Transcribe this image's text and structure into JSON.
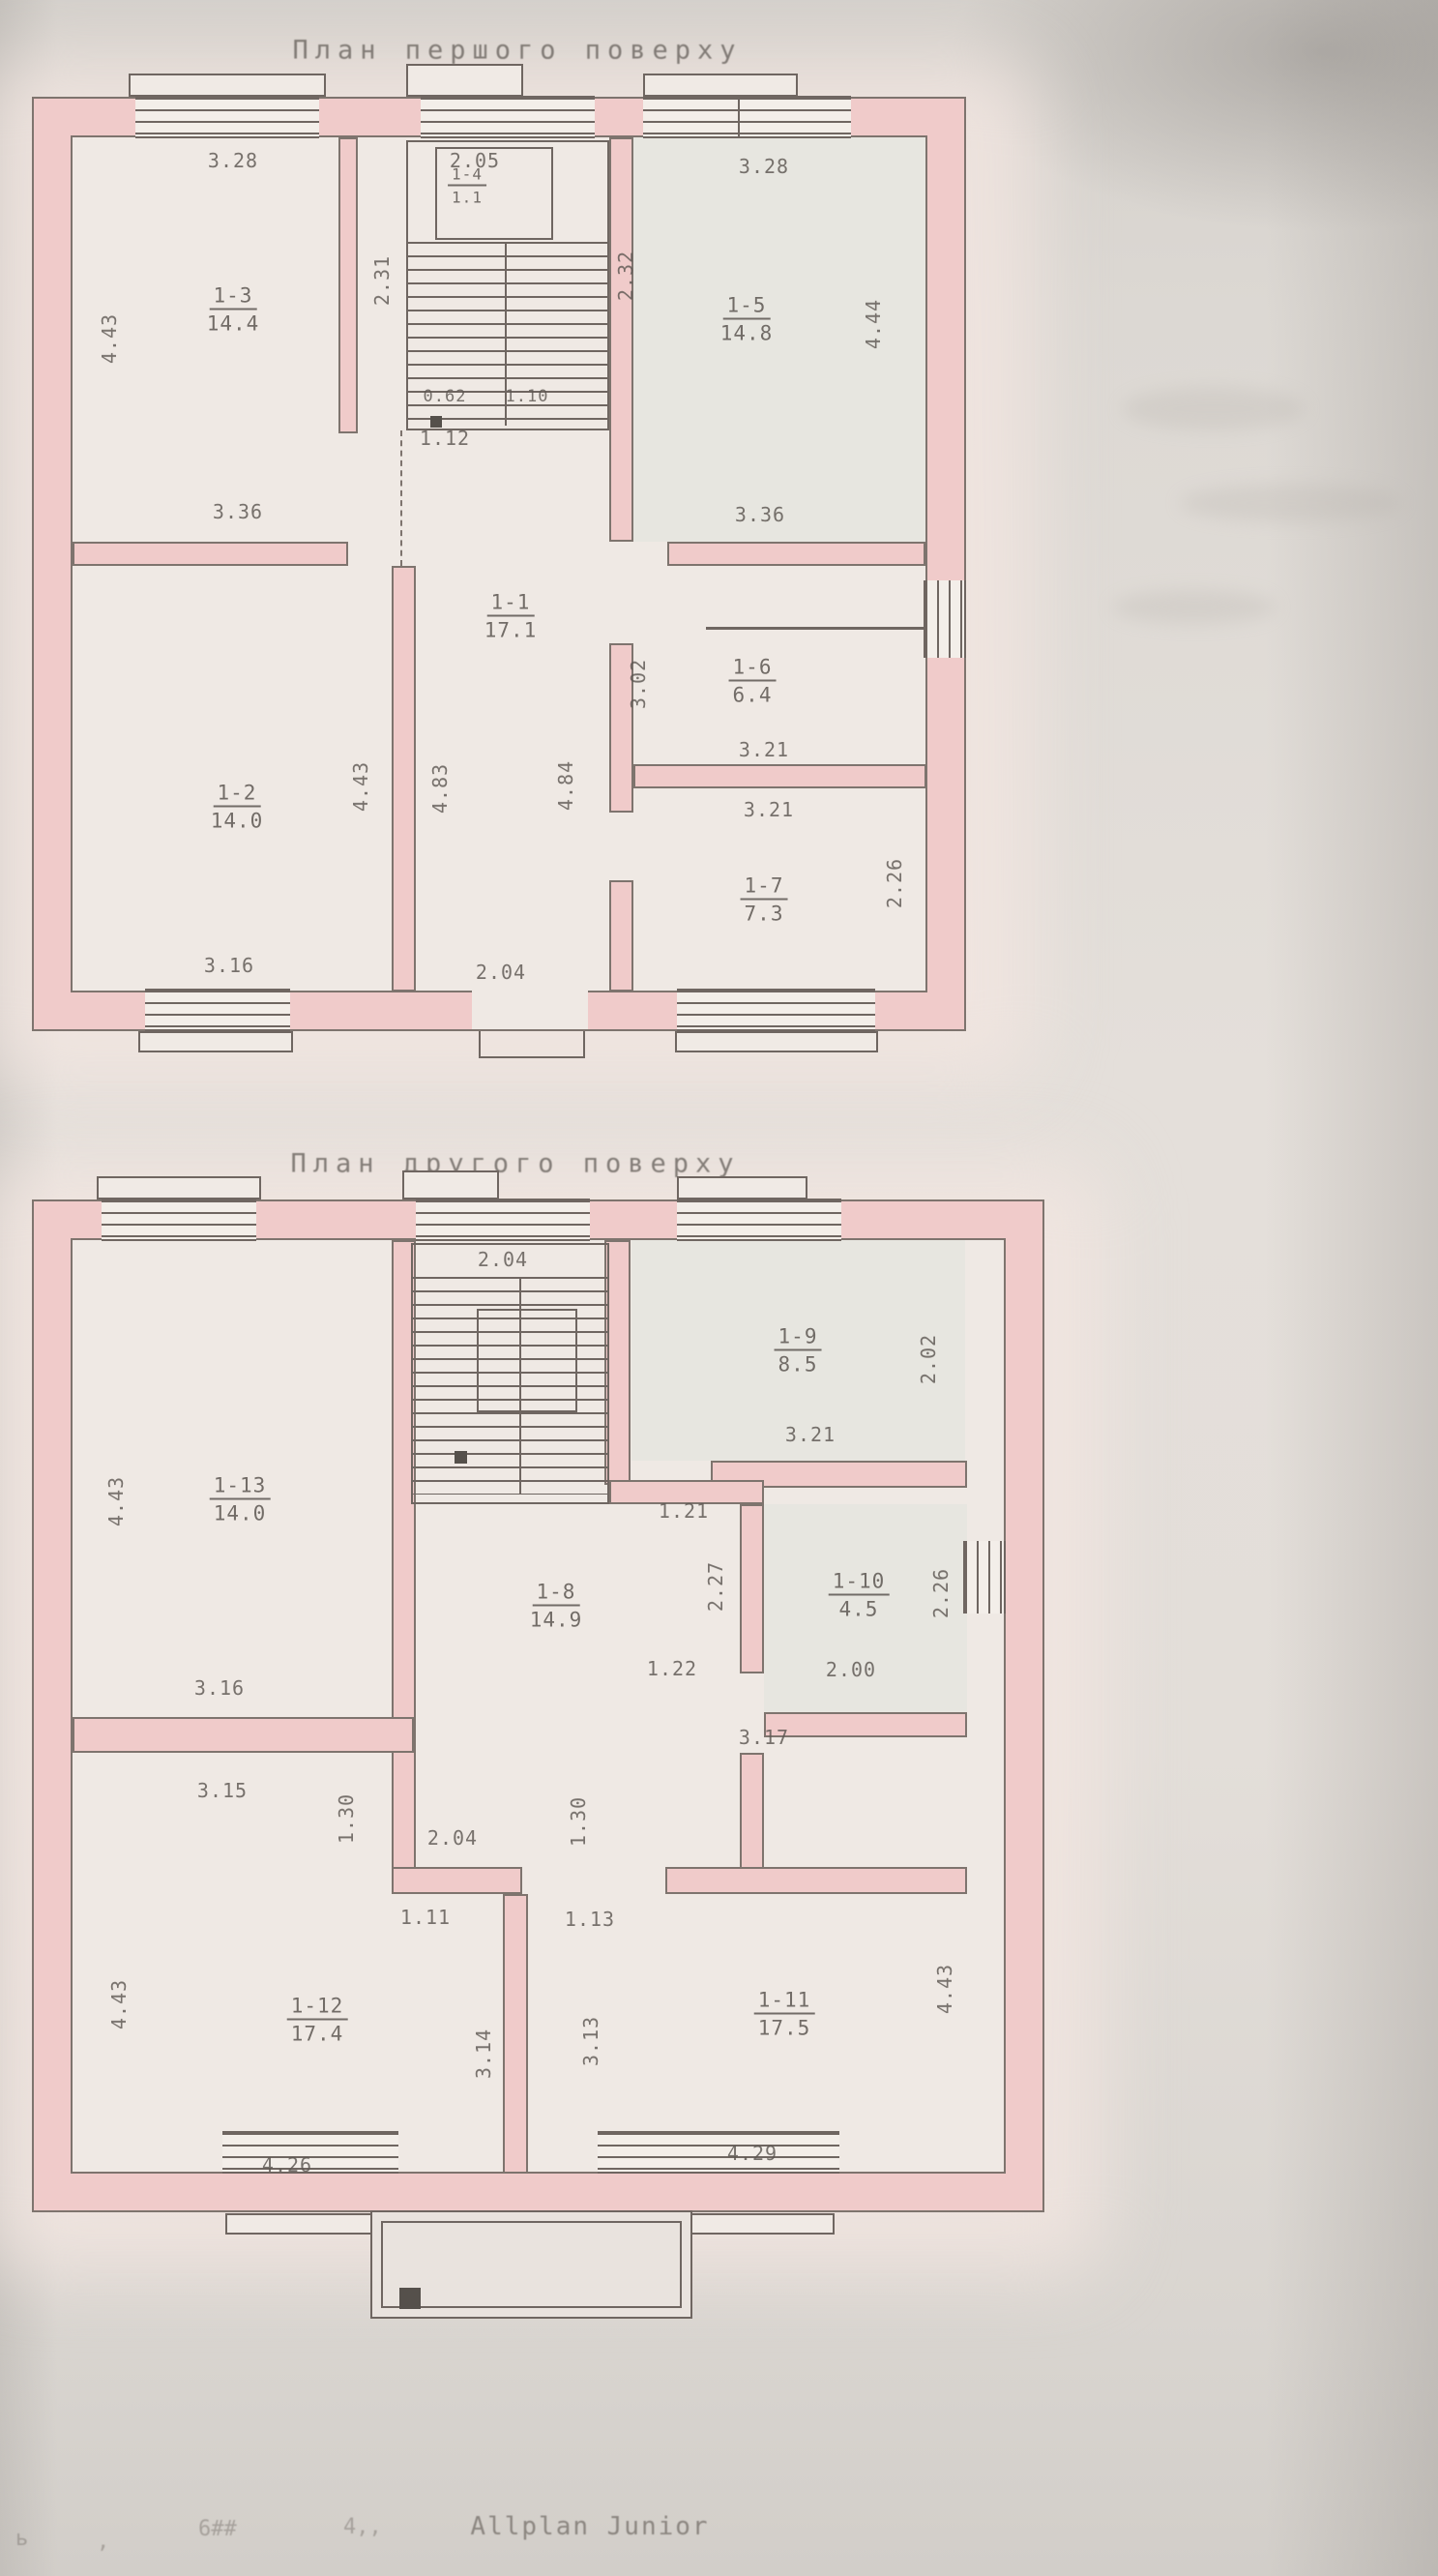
{
  "floor1": {
    "title": "План першого поверху",
    "rooms": {
      "r1": {
        "id": "1-1",
        "area": "17.1"
      },
      "r2": {
        "id": "1-2",
        "area": "14.0"
      },
      "r3": {
        "id": "1-3",
        "area": "14.4"
      },
      "r4": {
        "id": "1-4",
        "area": "1.1"
      },
      "r5": {
        "id": "1-5",
        "area": "14.8"
      },
      "r6": {
        "id": "1-6",
        "area": "6.4"
      },
      "r7": {
        "id": "1-7",
        "area": "7.3"
      }
    },
    "dims": {
      "r3_top": "3.28",
      "r3_left": "4.43",
      "r3_bottom": "3.36",
      "stair_top": "2.05",
      "stair_left": "2.31",
      "stair_right": "2.32",
      "stair_w1": "0.62",
      "stair_w2": "1.10",
      "stair_below": "1.12",
      "r5_top": "3.28",
      "r5_right": "4.44",
      "r5_bottom": "3.36",
      "hall_left": "4.83",
      "hall_right": "4.84",
      "hall_door": "2.04",
      "r6_left": "3.02",
      "r6_bottom": "3.21",
      "r7_top": "3.21",
      "r7_right": "2.26",
      "r2_right": "4.43",
      "r2_bottom": "3.16"
    }
  },
  "floor2": {
    "title": "План другого поверху",
    "rooms": {
      "r8": {
        "id": "1-8",
        "area": "14.9"
      },
      "r9": {
        "id": "1-9",
        "area": "8.5"
      },
      "r10": {
        "id": "1-10",
        "area": "4.5"
      },
      "r11": {
        "id": "1-11",
        "area": "17.5"
      },
      "r12": {
        "id": "1-12",
        "area": "17.4"
      },
      "r13": {
        "id": "1-13",
        "area": "14.0"
      }
    },
    "dims": {
      "stair_top": "2.04",
      "r13_left": "4.43",
      "r13_bottom": "3.16",
      "r9_bottom": "3.21",
      "r9_right": "2.02",
      "hall_right_top": "1.21",
      "hall_right_mid": "2.27",
      "hall_right_bottom": "1.22",
      "r10_bottom": "2.00",
      "r10_right": "2.26",
      "corridor": "3.17",
      "r12_top": "3.15",
      "seg_left": "1.30",
      "seg_right": "1.30",
      "hall_door": "2.04",
      "w_left": "1.11",
      "w_right": "1.13",
      "r12_left": "4.43",
      "r12_bottom": "4.26",
      "r12_right": "3.14",
      "r11_left": "3.13",
      "r11_bottom": "4.29",
      "r11_right": "4.43"
    }
  },
  "footer": {
    "marks": [
      "ь",
      ",",
      "6##",
      "4,,"
    ],
    "brand": "Allplan Junior"
  }
}
